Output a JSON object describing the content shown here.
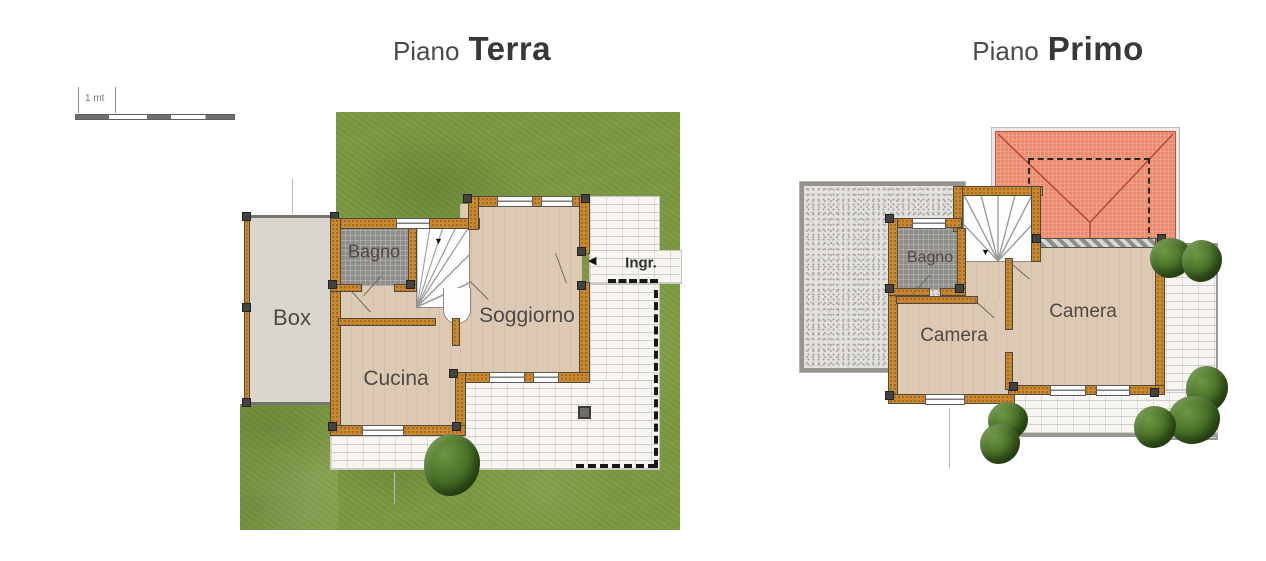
{
  "scale_bar": {
    "label": "1 mt"
  },
  "plans": [
    {
      "title_prefix": "Piano",
      "title_name": "Terra",
      "rooms": {
        "box": "Box",
        "bagno": "Bagno",
        "cucina": "Cucina",
        "soggiorno": "Soggiorno"
      },
      "entrance": "Ingr."
    },
    {
      "title_prefix": "Piano",
      "title_name": "Primo",
      "rooms": {
        "bagno": "Bagno",
        "camera_left": "Camera",
        "camera_right": "Camera"
      }
    }
  ],
  "icons": {
    "stairs_down_arrow": "▼",
    "entry_arrow": "◀"
  },
  "colors": {
    "wall": "#c9882f",
    "grass": "#7e9b44",
    "wood_floor": "#dccab4",
    "tile_floor": "#8f8d89",
    "paving": "#f7f6f3",
    "gravel": "#e4e2df",
    "roof": "#eb8a6f",
    "bush_green": "#406821",
    "box_floor": "#d9d6d0",
    "title_text": "#383838"
  }
}
